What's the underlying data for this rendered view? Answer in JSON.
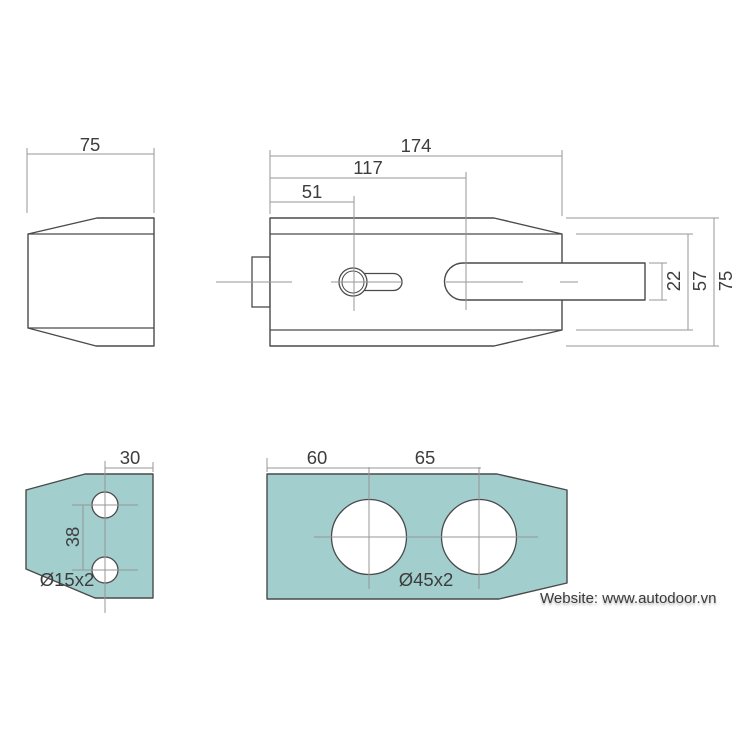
{
  "drawing": {
    "type": "technical-drawing-lock",
    "colors": {
      "background": "#ffffff",
      "plate_fill": "#a2cecd",
      "outline": "#4a4a4a",
      "thin_line": "#979797",
      "text": "#3d3d3d"
    },
    "side_view": {
      "width": "75"
    },
    "front_view": {
      "width_total": "174",
      "width_to_bolt_center": "117",
      "width_to_keyhole": "51",
      "bolt_height": "22",
      "inner_height": "57",
      "height_total": "75"
    },
    "strike_plate": {
      "hole_edge_offset": "30",
      "hole_spacing": "38",
      "hole_label": "Ø15x2"
    },
    "mounting_plate": {
      "left_hole_offset": "60",
      "hole_spacing": "65",
      "hole_label": "Ø45x2"
    },
    "footer": {
      "website": "Website: www.autodoor.vn"
    }
  }
}
